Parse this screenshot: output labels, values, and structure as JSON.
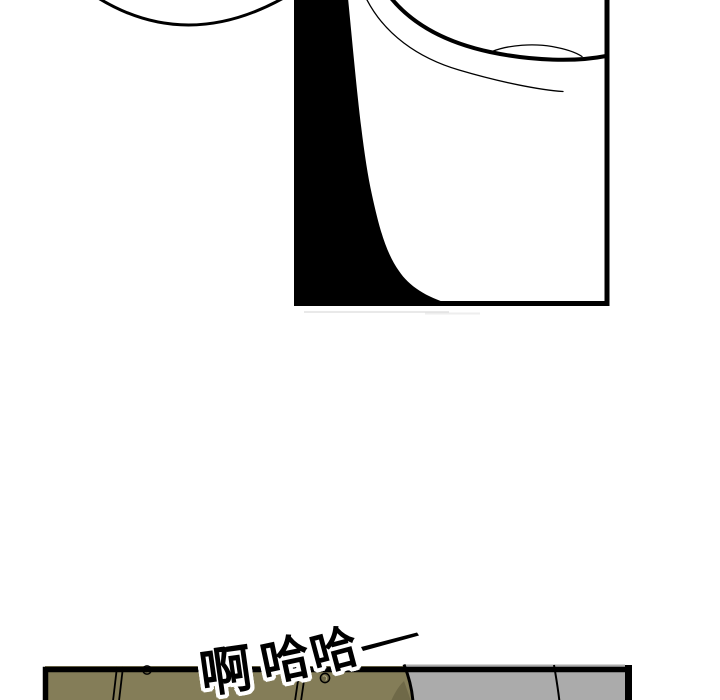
{
  "colors": {
    "ink": "#000000",
    "paper": "#ffffff",
    "jacket_khaki": "#847d58",
    "jacket_khaki_shadow": "#6d6747",
    "coat_gray": "#ababab"
  },
  "sfx": {
    "text": "啊哈哈",
    "chars": [
      "啊",
      "哈",
      "哈"
    ]
  }
}
